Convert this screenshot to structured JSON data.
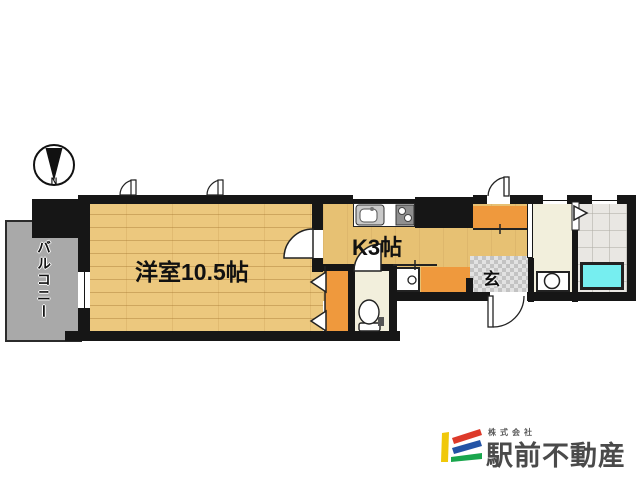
{
  "plan": {
    "compass": {
      "letter": "N"
    },
    "rooms": {
      "balcony": {
        "label": "バルコニー"
      },
      "western_room": {
        "label": "洋室10.5帖"
      },
      "kitchen": {
        "label": "K3帖"
      },
      "entrance": {
        "label": "玄"
      }
    },
    "fixtures": [
      "kitchen-sink",
      "stove",
      "toilet",
      "washbasin",
      "washing-machine",
      "bathtub"
    ],
    "colors": {
      "wall": "#161616",
      "wood_floor": "#ecc87e",
      "tan_floor": "#e7c173",
      "orange_storage": "#ef993d",
      "cream_floor": "#f2efdc",
      "bath_tile": "#e9e7e3",
      "bathtub": "#76eef0",
      "balcony_gray": "#a9a9a9",
      "genkan_tile": "#d0d0d0"
    }
  },
  "logo": {
    "company_prefix": "株式会社",
    "company_name": "駅前不動産",
    "colors": {
      "yellow": "#f0c80a",
      "red": "#dd3a2a",
      "blue": "#2353a5",
      "green": "#19a64d",
      "text": "#4a4a4a"
    }
  }
}
